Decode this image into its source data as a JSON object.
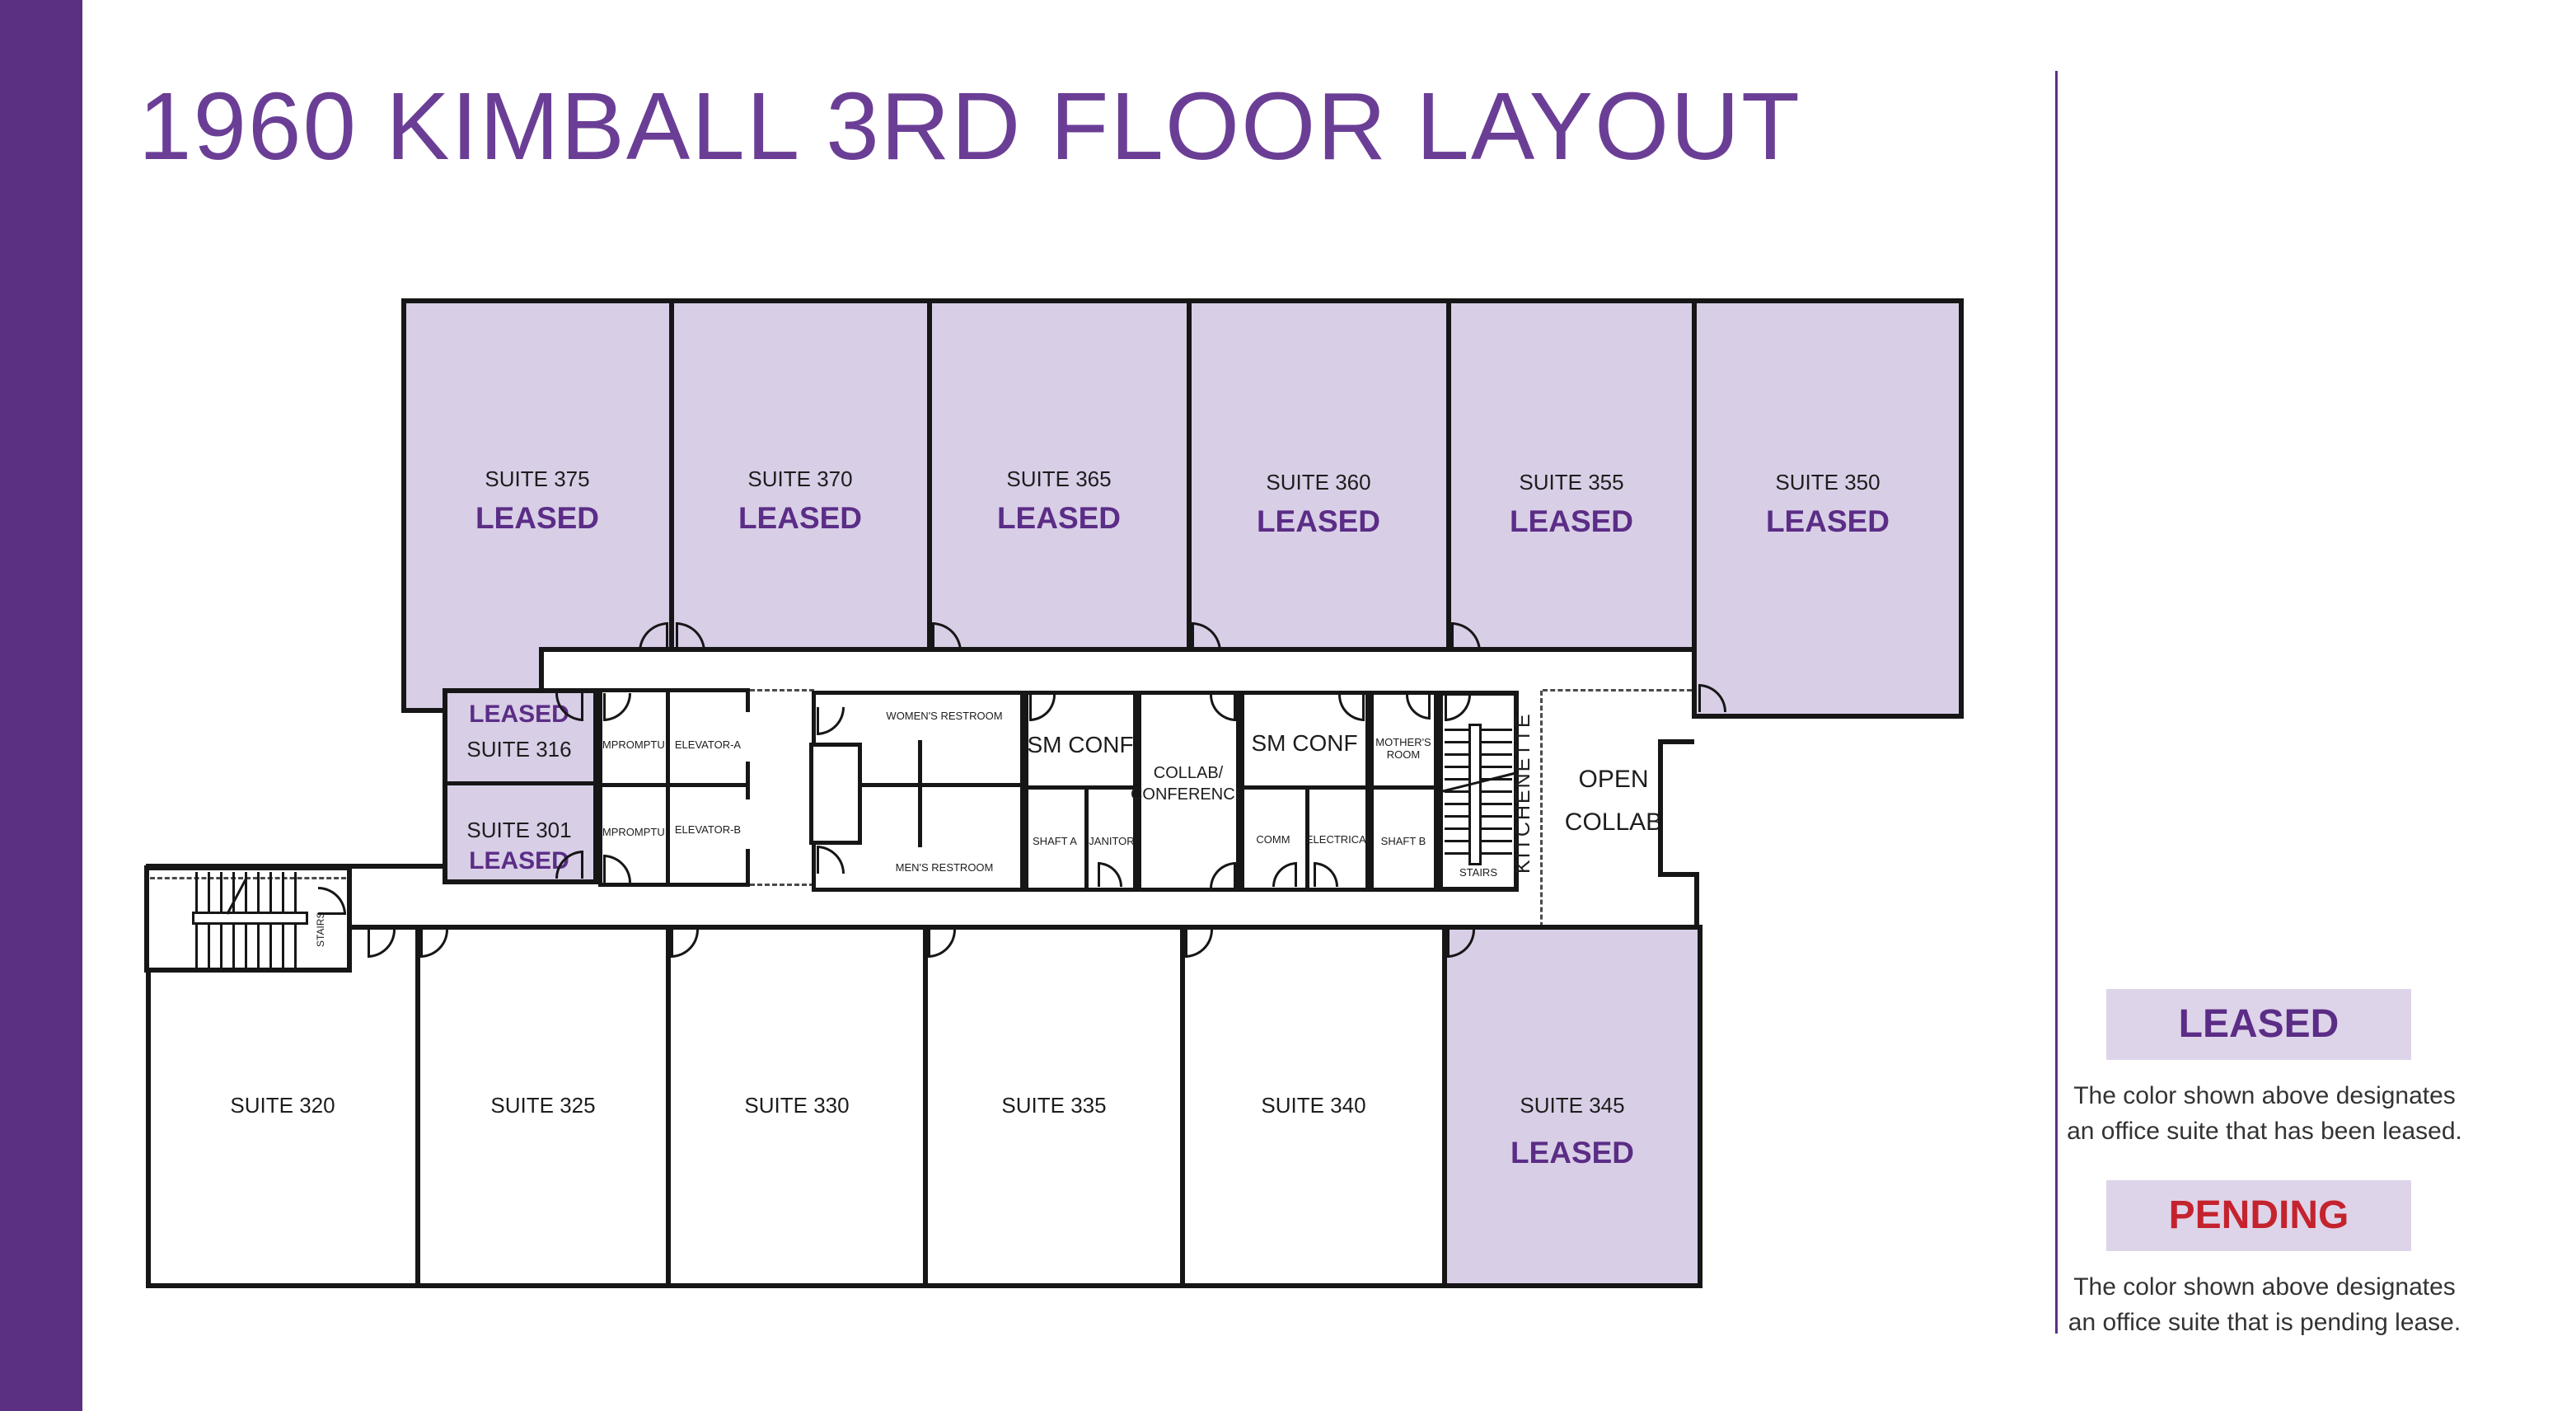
{
  "title": "1960 KIMBALL 3RD FLOOR LAYOUT",
  "colors": {
    "brand_purple": "#5b3083",
    "title_purple": "#6b3e96",
    "leased_fill": "#d8cee6",
    "leased_text": "#5b2d86",
    "pending_text": "#c4232e",
    "wall": "#161616",
    "legend_fill": "#ded4ea"
  },
  "plan": {
    "top_suites": [
      {
        "name": "SUITE 375",
        "status": "LEASED"
      },
      {
        "name": "SUITE 370",
        "status": "LEASED"
      },
      {
        "name": "SUITE 365",
        "status": "LEASED"
      },
      {
        "name": "SUITE 360",
        "status": "LEASED"
      },
      {
        "name": "SUITE 355",
        "status": "LEASED"
      },
      {
        "name": "SUITE 350",
        "status": "LEASED"
      }
    ],
    "bottom_suites": [
      {
        "name": "SUITE 320",
        "status": ""
      },
      {
        "name": "SUITE 325",
        "status": ""
      },
      {
        "name": "SUITE 330",
        "status": ""
      },
      {
        "name": "SUITE 335",
        "status": ""
      },
      {
        "name": "SUITE 340",
        "status": ""
      },
      {
        "name": "SUITE 345",
        "status": "LEASED"
      }
    ],
    "core": {
      "suite316_status": "LEASED",
      "suite316_name": "SUITE 316",
      "suite301_name": "SUITE 301",
      "suite301_status": "LEASED",
      "impromptu_a": "IMPROMPTU",
      "impromptu_b": "IMPROMPTU",
      "elevator_a": "ELEVATOR-A",
      "elevator_b": "ELEVATOR-B",
      "womens_restroom": "WOMEN'S RESTROOM",
      "mens_restroom": "MEN'S RESTROOM",
      "sm_conf_1": "SM CONF",
      "shaft_a": "SHAFT A",
      "janitor": "JANITOR",
      "collab_line1": "COLLAB/",
      "collab_line2": "CONFERENCE",
      "sm_conf_2": "SM CONF",
      "comm": "COMM",
      "electrical": "ELECTRICAL",
      "mothers_room_line1": "MOTHER'S",
      "mothers_room_line2": "ROOM",
      "shaft_b": "SHAFT B",
      "stairs_core": "STAIRS",
      "stairs_west": "STAIRS",
      "kitchenette": "KITCHENETTE",
      "open_collab_line1": "OPEN",
      "open_collab_line2": "COLLAB"
    }
  },
  "legend": {
    "leased_label": "LEASED",
    "leased_desc1": "The color shown above designates",
    "leased_desc2": "an office suite that has been leased.",
    "pending_label": "PENDING",
    "pending_desc1": "The color shown above designates",
    "pending_desc2": "an office suite that is pending lease."
  }
}
